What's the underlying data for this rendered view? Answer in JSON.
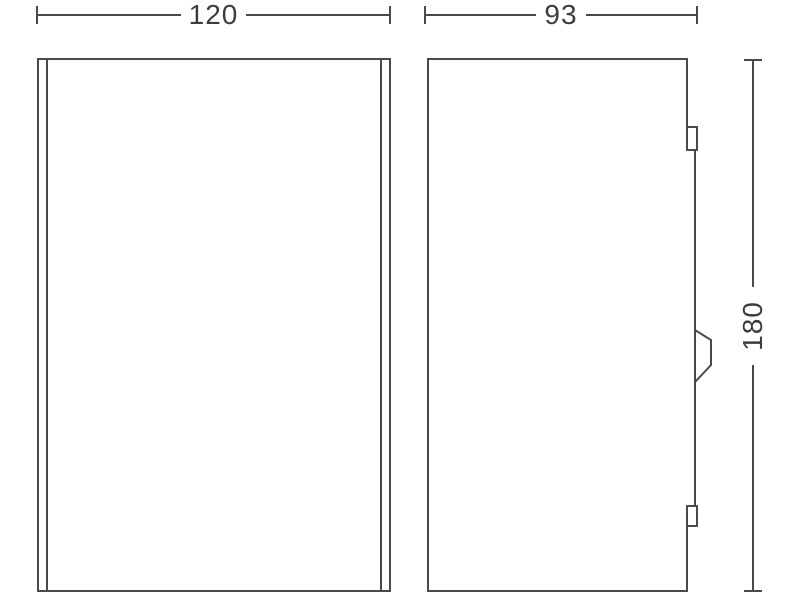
{
  "drawing": {
    "kind": "product-dimension-drawing",
    "units_shown": false,
    "dimensions": {
      "width": "120",
      "depth": "93",
      "height": "180"
    },
    "colors": {
      "line": "#4a4a4a",
      "text": "#3d3d3d",
      "background": "#ffffff"
    }
  }
}
